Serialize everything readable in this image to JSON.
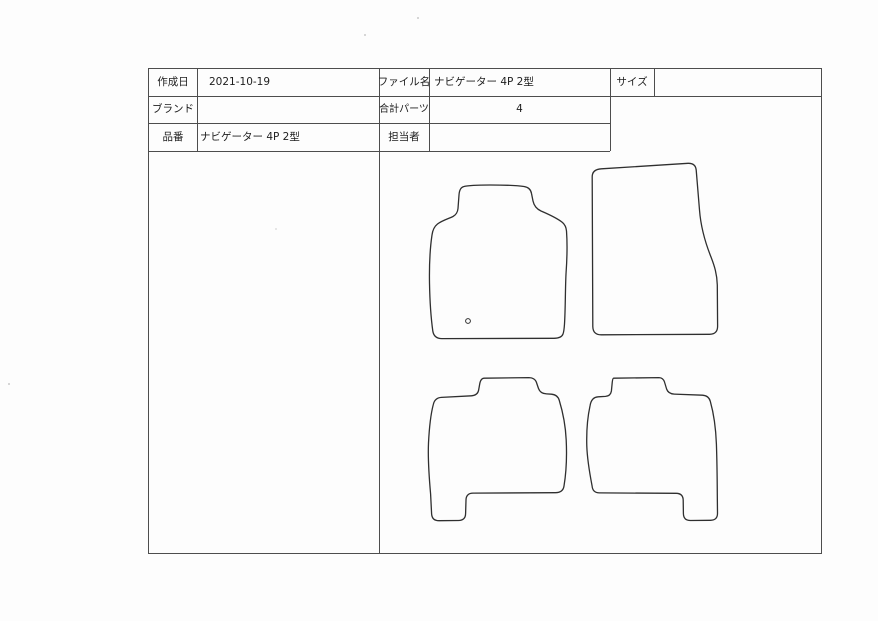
{
  "header": {
    "created_date": {
      "label": "作成日",
      "value": "2021-10-19"
    },
    "brand": {
      "label": "ブランド",
      "value": ""
    },
    "part_no": {
      "label": "品番",
      "value": "ナビゲーター 4P 2型"
    },
    "file_name": {
      "label": "ファイル名",
      "value": "ナビゲーター 4P 2型"
    },
    "total_parts": {
      "label": "合計パーツ",
      "value": "4"
    },
    "staff": {
      "label": "担当者",
      "value": ""
    },
    "size": {
      "label": "サイズ",
      "value": ""
    }
  },
  "drawing": {
    "parts_shown": 4,
    "mats": [
      {
        "name": "front-left-mat",
        "feature": "eyelet-mark-circle"
      },
      {
        "name": "front-right-mat",
        "feature": ""
      },
      {
        "name": "rear-left-mat",
        "feature": "bottom-left-foot"
      },
      {
        "name": "rear-right-mat",
        "feature": "bottom-right-foot"
      }
    ]
  },
  "colors": {
    "outline": "#2f2f2f",
    "grid": "#4d4d4d",
    "paper": "#fdfdfd"
  }
}
